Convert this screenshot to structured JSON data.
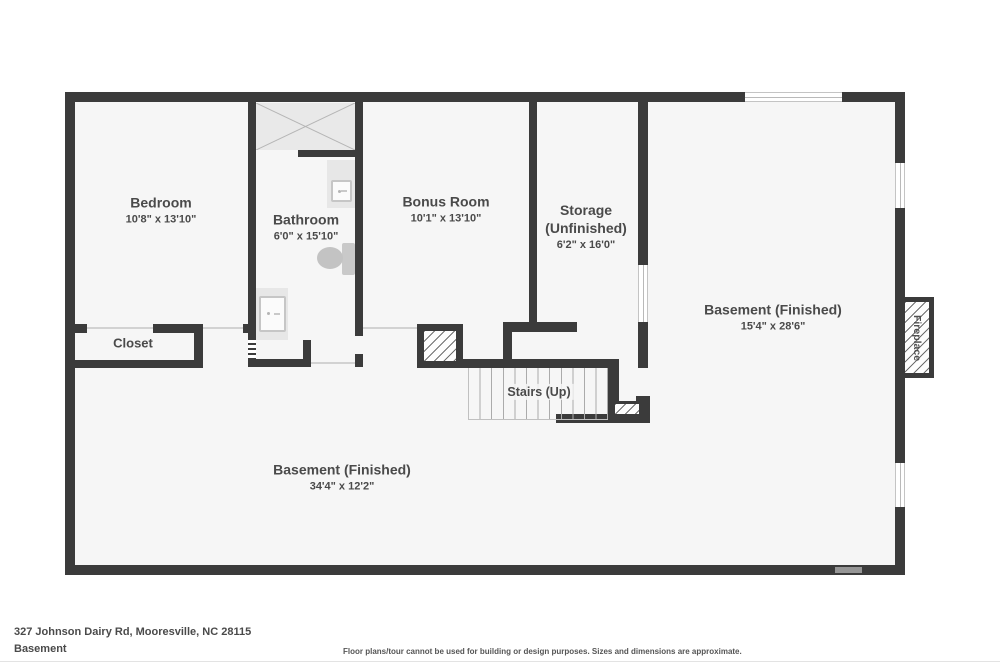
{
  "rooms": {
    "bedroom": {
      "name": "Bedroom",
      "dims": "10'8\" x 13'10\""
    },
    "bathroom": {
      "name": "Bathroom",
      "dims": "6'0\" x 15'10\""
    },
    "bonus_room": {
      "name": "Bonus Room",
      "dims": "10'1\" x 13'10\""
    },
    "storage": {
      "name": "Storage",
      "qualifier": "(Unfinished)",
      "dims": "6'2\" x 16'0\""
    },
    "basement_right": {
      "name": "Basement (Finished)",
      "dims": "15'4\" x 28'6\""
    },
    "basement_lower": {
      "name": "Basement (Finished)",
      "dims": "34'4\" x 12'2\""
    },
    "closet": {
      "name": "Closet"
    },
    "stairs": {
      "name": "Stairs (Up)"
    },
    "fireplace": {
      "name": "Fireplace"
    }
  },
  "footer": {
    "address": "327 Johnson Dairy Rd, Mooresville, NC 28115",
    "floor_label": "Basement",
    "disclaimer": "Floor plans/tour cannot be used for building or design purposes. Sizes and dimensions are approximate."
  },
  "colors": {
    "wall": "#3b3b3b",
    "floor": "#f6f6f6",
    "label_text": "#4a4a4a",
    "fixture_gray": "#e7e7e7"
  }
}
